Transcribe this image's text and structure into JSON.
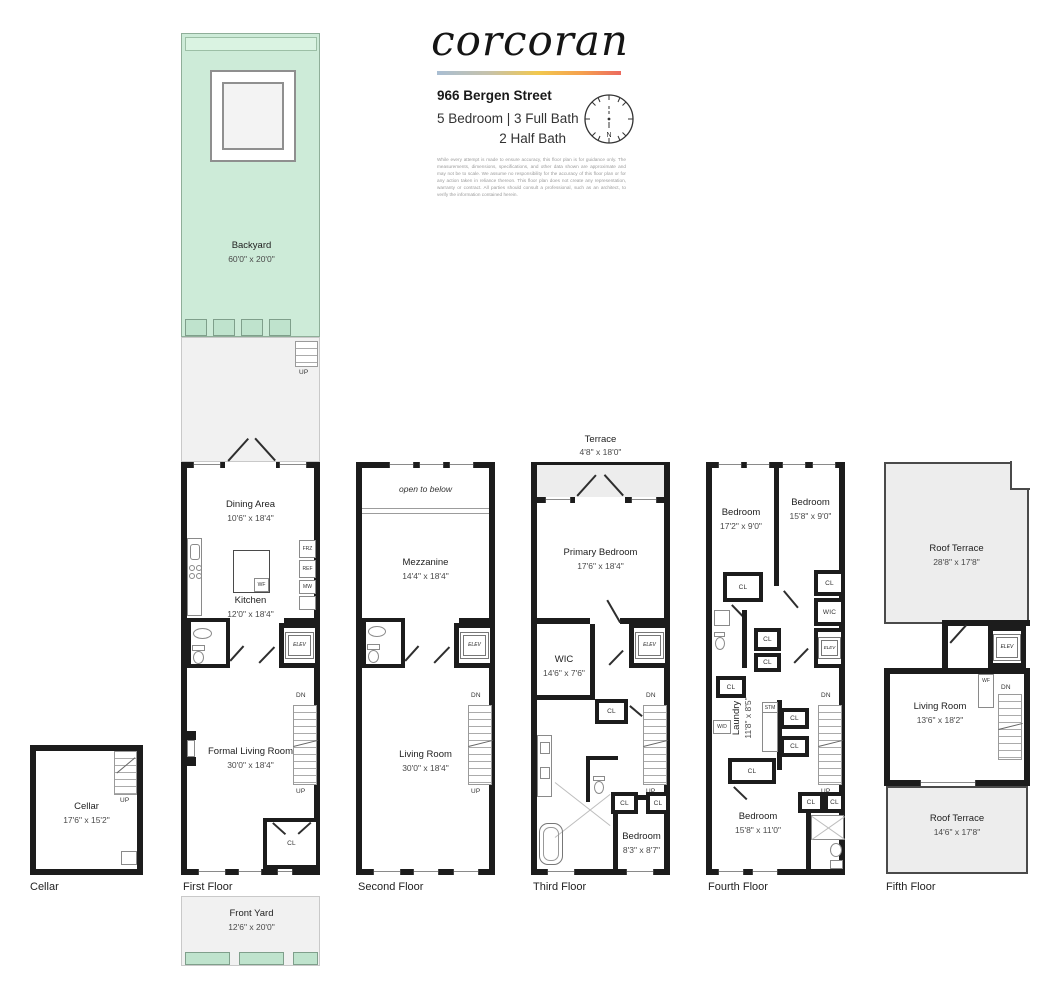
{
  "header": {
    "brand": "corcoran",
    "address": "966 Bergen Street",
    "line1": "5 Bedroom | 3 Full Bath",
    "line2": "2 Half Bath",
    "compass_n": "N",
    "disclaimer": "While every attempt is made to ensure accuracy, this floor plan is for guidance only. The measurements, dimensions, specifications, and other data shown are approximate and may not be to scale. We assume no responsibility for the accuracy of this floor plan or for any action taken in reliance thereon. This floor plan does not create any representation, warranty or contract. All parties should consult a professional, such as an architect, to verify the information contained herein."
  },
  "colors": {
    "wall": "#1c1c1c",
    "yard_green": "#cdebd8",
    "outdoor_gray": "#f1f1f1"
  },
  "common": {
    "up": "UP",
    "dn": "DN",
    "cl": "CL",
    "elev": "ELEV",
    "wic": "WIC",
    "wf": "WF"
  },
  "plans": {
    "backyard": {
      "name": "Backyard",
      "dims": "60'0\" x 20'0\""
    },
    "frontyard": {
      "name": "Front Yard",
      "dims": "12'6\" x 20'0\""
    },
    "cellar": {
      "page_label": "Cellar",
      "name": "Cellar",
      "dims": "17'6\" x 15'2\""
    },
    "first": {
      "page_label": "First Floor",
      "dining_name": "Dining Area",
      "dining_dims": "10'6\" x 18'4\"",
      "kitchen_name": "Kitchen",
      "kitchen_dims": "12'0\" x 18'4\"",
      "living_name": "Formal Living Room",
      "living_dims": "30'0\" x 18'4\"",
      "frz": "FRZ",
      "ref": "REF",
      "mw": "MW"
    },
    "second": {
      "page_label": "Second Floor",
      "open_below": "open to below",
      "mezz_name": "Mezzanine",
      "mezz_dims": "14'4\" x 18'4\"",
      "living_name": "Living Room",
      "living_dims": "30'0\" x 18'4\""
    },
    "third": {
      "page_label": "Third Floor",
      "terrace_name": "Terrace",
      "terrace_dims": "4'8\" x 18'0\"",
      "primary_name": "Primary Bedroom",
      "primary_dims": "17'6\" x 18'4\"",
      "wic_name": "WIC",
      "wic_dims": "14'6\" x 7'6\"",
      "bed_name": "Bedroom",
      "bed_dims": "8'3\" x 8'7\""
    },
    "fourth": {
      "page_label": "Fourth Floor",
      "bed1_name": "Bedroom",
      "bed1_dims": "17'2\" x 9'0\"",
      "bed2_name": "Bedroom",
      "bed2_dims": "15'8\" x 9'0\"",
      "bed3_name": "Bedroom",
      "bed3_dims": "15'8\" x 11'0\"",
      "laundry_name": "Laundry",
      "laundry_dims": "11'8\" x 8'5\"",
      "wd": "W/D",
      "stm": "STM"
    },
    "fifth": {
      "page_label": "Fifth Floor",
      "roof1_name": "Roof Terrace",
      "roof1_dims": "28'8\" x 17'8\"",
      "roof2_name": "Roof Terrace",
      "roof2_dims": "14'6\" x 17'8\"",
      "living_name": "Living Room",
      "living_dims": "13'6\" x 18'2\""
    }
  }
}
